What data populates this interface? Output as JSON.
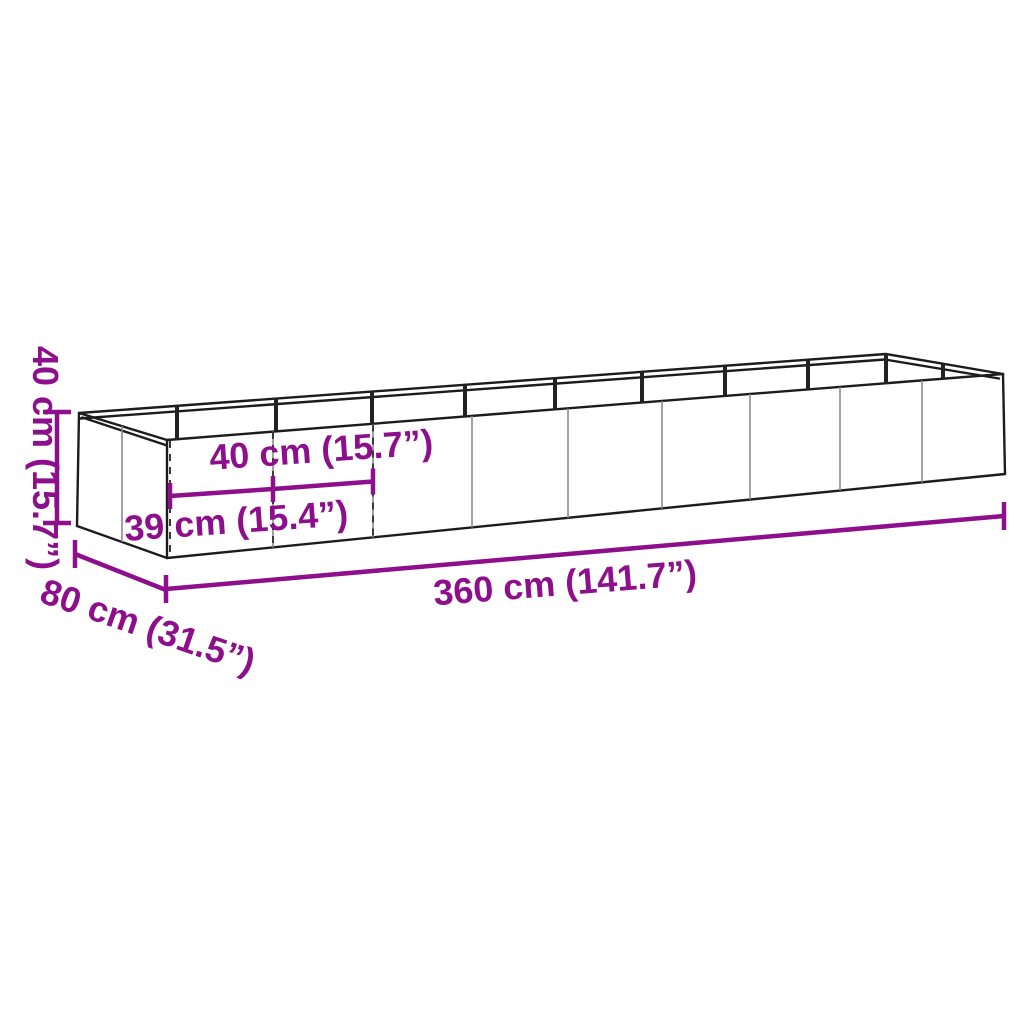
{
  "diagram": {
    "type": "product-dimension-diagram",
    "subject": "long rectangular metal garden planter / raised bed, open top, 3D line drawing with nine front panels",
    "background_color": "#ffffff",
    "accent_color": "#8E0F8C",
    "outline_color": "#1c1c1c",
    "panel_line_color": "#8a8a8a",
    "dashed_line_color": "#3a3a3a",
    "labels": {
      "height": "40 cm (15.7”)",
      "panel_width_top": "40 cm (15.7”)",
      "panel_width_bottom": "39 cm (15.4”)",
      "length": "360 cm (141.7”)",
      "depth": "80 cm (31.5”)"
    }
  }
}
